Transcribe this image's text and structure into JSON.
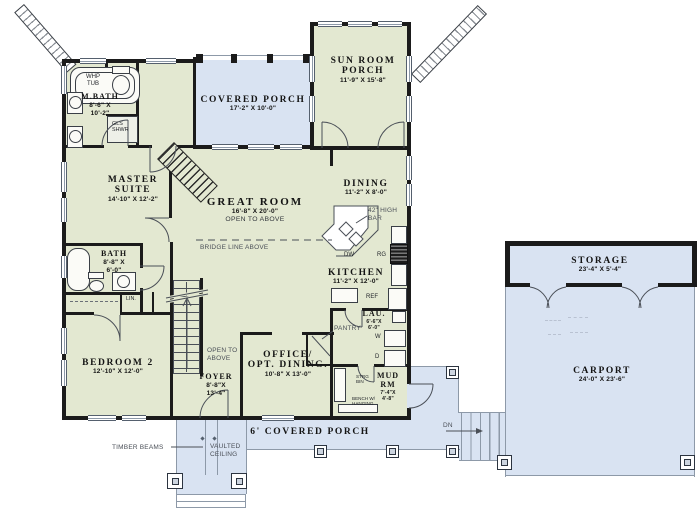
{
  "rooms": {
    "covered_porch": {
      "name": "COVERED PORCH",
      "dims": "17'-2\" X 10'-0\""
    },
    "sun_room": {
      "name": "SUN ROOM",
      "name2": "PORCH",
      "dims": "11'-9\" X 15'-8\""
    },
    "master_bath": {
      "name": "M.BATH",
      "dims": "8'-6\" X",
      "dims2": "10'-2\""
    },
    "master_suite": {
      "name": "MASTER",
      "name2": "SUITE",
      "dims": "14'-10\" X 12'-2\""
    },
    "great_room": {
      "name": "GREAT ROOM",
      "dims": "16'-8\" X 20'-0\"",
      "note": "OPEN TO ABOVE"
    },
    "dining": {
      "name": "DINING",
      "dims": "11'-2\" X 8'-0\""
    },
    "kitchen": {
      "name": "KITCHEN",
      "dims": "11'-2\" X 12'-0\""
    },
    "bath": {
      "name": "BATH",
      "dims": "8'-8\" X",
      "dims2": "6'-0\""
    },
    "bedroom_2": {
      "name": "BEDROOM 2",
      "dims": "12'-10\" X 12'-0\""
    },
    "foyer": {
      "name": "FOYER",
      "dims": "8'-8\"X",
      "dims2": "13'-4\""
    },
    "office": {
      "name": "OFFICE/",
      "name2": "OPT. DINING.",
      "dims": "10'-8\" X 13'-0\""
    },
    "laundry": {
      "name": "LAU.",
      "dims": "6'-6\"X",
      "dims2": "6'-0\""
    },
    "mud_room": {
      "name": "MUD",
      "name2": "RM",
      "dims": "7'-4\"X",
      "dims2": "4'-8\""
    },
    "storage": {
      "name": "STORAGE",
      "dims": "23'-4\" X 5'-4\""
    },
    "carport": {
      "name": "CARPORT",
      "dims": "24'-0\" X 23'-6\""
    },
    "front_porch": {
      "name": "6' COVERED PORCH"
    }
  },
  "annotations": {
    "open_to_above_1": "OPEN TO",
    "open_to_above_2": "ABOVE",
    "bridge_line": "BRIDGE LINE ABOVE",
    "bar_1": "42\" HIGH",
    "bar_2": "BAR",
    "timber_beams": "TIMBER BEAMS",
    "vaulted_1": "VAULTED",
    "vaulted_2": "CEILING",
    "down": "DN",
    "pantry": "PANTRY",
    "linen": "LIN."
  },
  "fixtures": {
    "whirlpool_1": "WHP",
    "whirlpool_2": "TUB",
    "glass_shower_1": "GLS",
    "glass_shower_2": "SHWR",
    "dishwasher": "DW",
    "range": "RG",
    "refrigerator": "REF",
    "washer": "W",
    "dryer": "D",
    "storage_bin_1": "STRG",
    "storage_bin_2": "BIN",
    "bench_1": "BENCH W/",
    "bench_2": "HANGING"
  },
  "colors": {
    "room_fill": "#e3e8d1",
    "porch_fill": "#d9e3f2",
    "wall": "#1b1b1b",
    "line": "#8d99a8"
  }
}
